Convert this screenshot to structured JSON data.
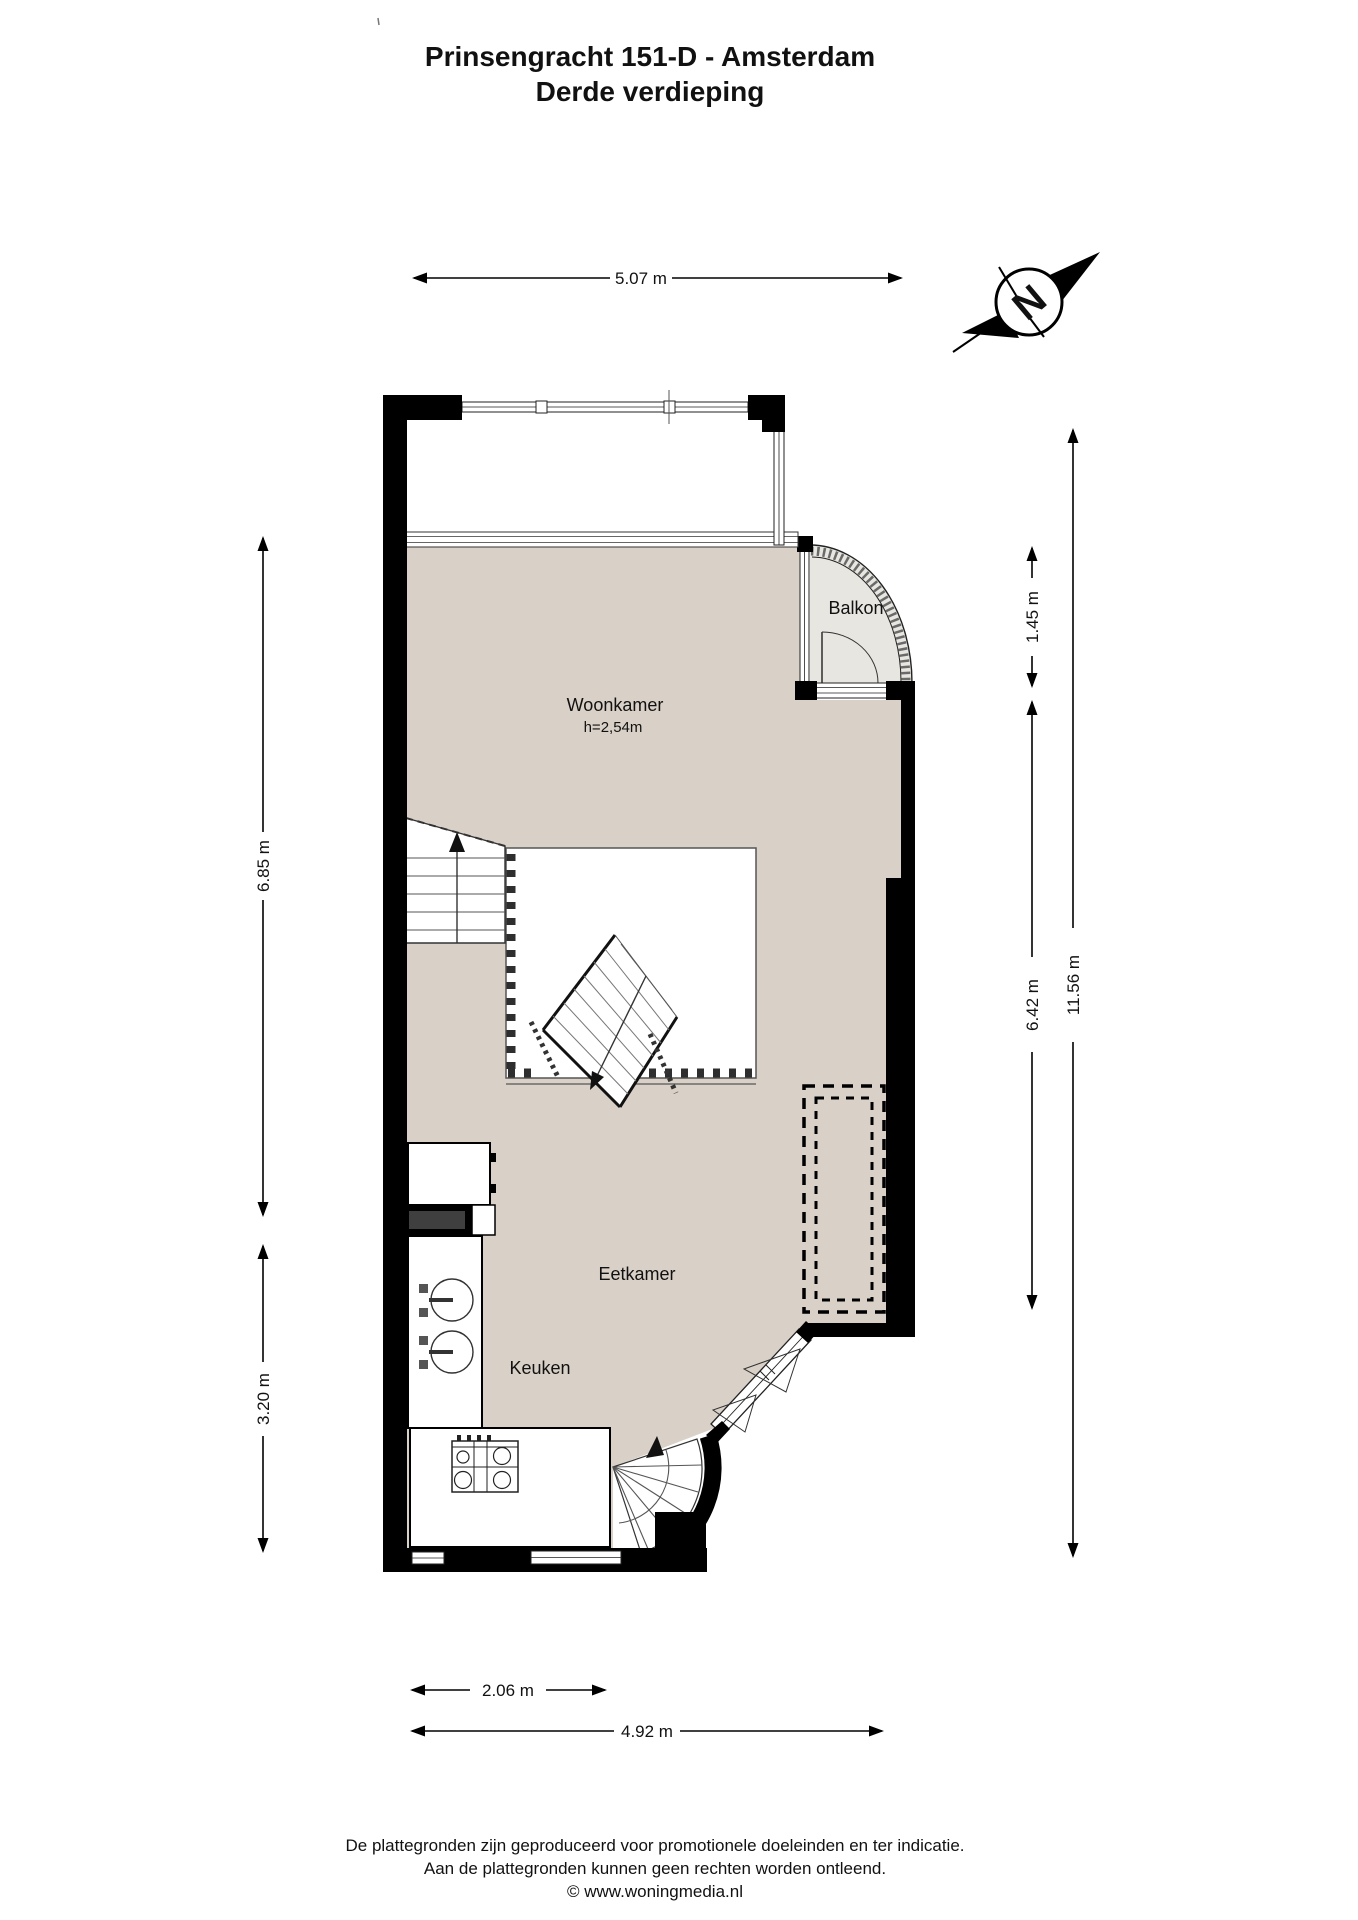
{
  "title": {
    "line1": "Prinsengracht 151-D - Amsterdam",
    "line2": "Derde verdieping"
  },
  "compass": {
    "north_label": "N"
  },
  "rooms": {
    "woonkamer": {
      "label": "Woonkamer",
      "ceiling_height": "h=2,54m"
    },
    "balkon": {
      "label": "Balkon"
    },
    "eetkamer": {
      "label": "Eetkamer"
    },
    "keuken": {
      "label": "Keuken"
    }
  },
  "dimensions": {
    "top_width": "5.07 m",
    "left_upper": "6.85 m",
    "left_lower": "3.20 m",
    "right_balcony": "1.45 m",
    "right_inner": "6.42 m",
    "right_total": "11.56 m",
    "bottom_kitchen": "2.06 m",
    "bottom_total": "4.92 m"
  },
  "footer": {
    "line1": "De plattegronden zijn geproduceerd voor promotionele doeleinden en ter indicatie.",
    "line2": "Aan de plattegronden kunnen geen rechten worden ontleend.",
    "line3": "© www.woningmedia.nl"
  },
  "colors": {
    "floor": "#d9d1c7",
    "balcony_floor": "#e8e6e1",
    "wall": "#000000"
  }
}
